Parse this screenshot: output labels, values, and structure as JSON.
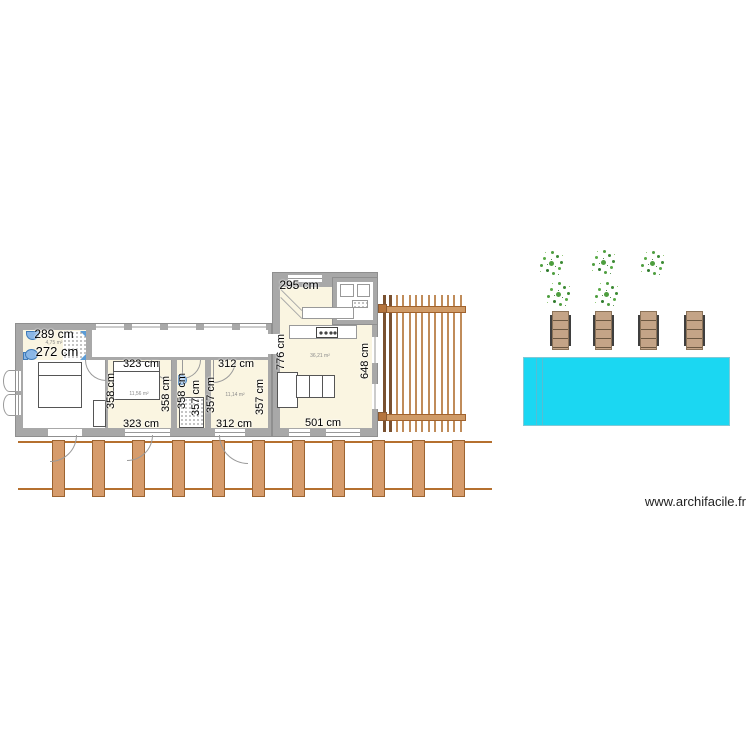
{
  "plan": {
    "bathroom": {
      "dim_top": "289 cm",
      "dim_bottom": "272 cm",
      "area": "4,75 m²"
    },
    "bedroom2": {
      "dim_top": "323 cm",
      "dim_bottom": "323 cm",
      "dim_left": "358 cm",
      "dim_right": "358 cm",
      "area": "11,56 m²"
    },
    "shower_room": {
      "dim_left": "358 cm",
      "dim_right": "357 cm"
    },
    "bedroom3": {
      "dim_top": "312 cm",
      "dim_bottom": "312 cm",
      "dim_left": "357 cm",
      "dim_right": "357 cm",
      "area": "11,14 m²"
    },
    "living_room": {
      "dim_top": "295 cm",
      "dim_left": "776 cm",
      "dim_right": "648 cm",
      "dim_bottom": "501 cm",
      "area": "36,21 m²"
    }
  },
  "exterior": {
    "pool_color": "#1bd7f2",
    "tree_count": 5,
    "lounger_count": 4,
    "deck_plank_count": 11,
    "pergola_slat_count": 13
  },
  "colors": {
    "wall": "#a8a8a8",
    "floor": "#faf5e1",
    "wood": "#d69c6c",
    "fixture_blue": "#5b9bd5",
    "tree_green": "#4e9e3f"
  },
  "site": {
    "watermark": "www.archifacile.fr"
  }
}
